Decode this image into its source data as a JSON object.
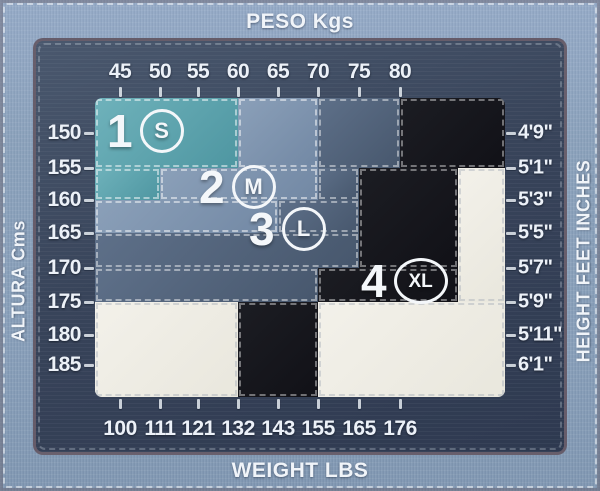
{
  "titles": {
    "top": "PESO Kgs",
    "bottom": "WEIGHT LBS",
    "left": "ALTURA Cms",
    "right": "HEIGHT FEET INCHES"
  },
  "chart_data": {
    "type": "heatmap",
    "x_axis": {
      "label": "PESO Kgs",
      "unit": "kg",
      "ticks": [
        "45",
        "50",
        "55",
        "60",
        "65",
        "70",
        "75",
        "80"
      ]
    },
    "x_axis_secondary": {
      "label": "WEIGHT LBS",
      "unit": "lbs",
      "ticks": [
        "100",
        "111",
        "121",
        "132",
        "143",
        "155",
        "165",
        "176"
      ]
    },
    "y_axis": {
      "label": "ALTURA Cms",
      "unit": "cm",
      "ticks": [
        "150",
        "155",
        "160",
        "165",
        "170",
        "175",
        "180",
        "185"
      ]
    },
    "y_axis_secondary": {
      "label": "HEIGHT FEET INCHES",
      "ticks": [
        "4'9\"",
        "5'1\"",
        "5'3\"",
        "5'5\"",
        "5'7\"",
        "5'9\"",
        "5'11\"",
        "6'1\""
      ]
    },
    "legend_note": "zones are stair-stepped size regions; cream blocks are outside the size range",
    "zones": [
      {
        "id": "size-1-s",
        "number": "1",
        "letter": "S",
        "color_start": "#6FB2BB",
        "color_end": "#4E96A1",
        "dash": "rgba(255,255,255,0.5)",
        "label": {
          "x": 12,
          "y": 8,
          "wide": false
        },
        "rects": [
          {
            "x": 0,
            "y": 0,
            "w": 143,
            "h": 70
          },
          {
            "x": 0,
            "y": 70,
            "w": 65,
            "h": 32
          }
        ]
      },
      {
        "id": "size-2-m",
        "number": "2",
        "letter": "M",
        "color_start": "#8BA0B9",
        "color_end": "#7288A4",
        "dash": "rgba(255,255,255,0.5)",
        "label": {
          "x": 104,
          "y": 64,
          "wide": false
        },
        "rects": [
          {
            "x": 143,
            "y": 0,
            "w": 80,
            "h": 70
          },
          {
            "x": 65,
            "y": 70,
            "w": 158,
            "h": 32
          },
          {
            "x": 0,
            "y": 102,
            "w": 183,
            "h": 33
          }
        ]
      },
      {
        "id": "size-3-l",
        "number": "3",
        "letter": "L",
        "color_start": "#5E7089",
        "color_end": "#47576D",
        "dash": "rgba(255,255,255,0.45)",
        "label": {
          "x": 154,
          "y": 106,
          "wide": false
        },
        "rects": [
          {
            "x": 223,
            "y": 0,
            "w": 82,
            "h": 70
          },
          {
            "x": 223,
            "y": 70,
            "w": 41,
            "h": 32
          },
          {
            "x": 183,
            "y": 102,
            "w": 81,
            "h": 33
          },
          {
            "x": 0,
            "y": 135,
            "w": 264,
            "h": 35
          },
          {
            "x": 0,
            "y": 170,
            "w": 223,
            "h": 34
          }
        ]
      },
      {
        "id": "size-4-xl",
        "number": "4",
        "letter": "XL",
        "color_start": "#1C1D23",
        "color_end": "#111117",
        "dash": "rgba(255,255,255,0.4)",
        "label": {
          "x": 266,
          "y": 158,
          "wide": true
        },
        "rects": [
          {
            "x": 305,
            "y": 0,
            "w": 105,
            "h": 70
          },
          {
            "x": 264,
            "y": 70,
            "w": 99,
            "h": 100
          },
          {
            "x": 223,
            "y": 170,
            "w": 140,
            "h": 34
          },
          {
            "x": 143,
            "y": 204,
            "w": 80,
            "h": 95
          }
        ]
      },
      {
        "id": "out-of-range",
        "number": null,
        "letter": null,
        "color_start": "#F3F1EA",
        "color_end": "#E9E7DD",
        "dash": "rgba(150,160,175,0.35)",
        "label": null,
        "rects": [
          {
            "x": 363,
            "y": 70,
            "w": 47,
            "h": 134
          },
          {
            "x": 223,
            "y": 204,
            "w": 187,
            "h": 95
          },
          {
            "x": 0,
            "y": 204,
            "w": 143,
            "h": 95
          }
        ]
      }
    ]
  },
  "palette": {
    "page_bg": "#8CA3BC",
    "panel_bg": "#3B4760",
    "panel_border": "#6E616D",
    "text": "#EDF2F8",
    "tick": "#F4F8FC"
  }
}
